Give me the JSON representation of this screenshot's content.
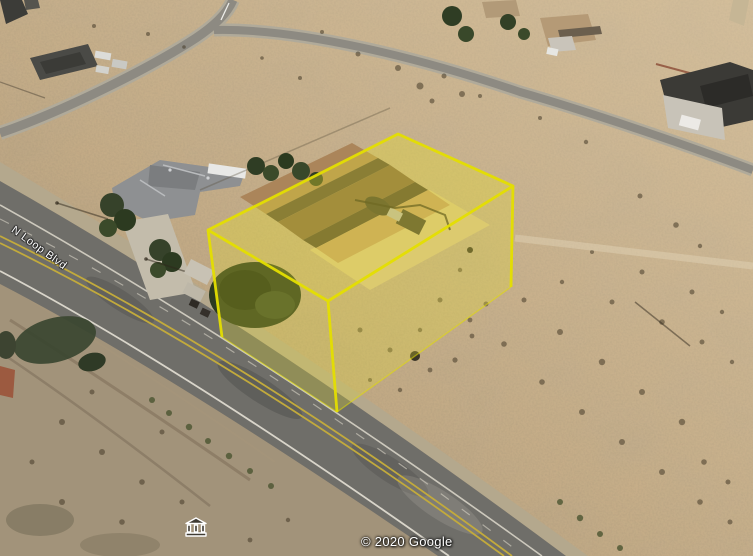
{
  "map": {
    "road_label": "N Loop Blvd",
    "attribution": "© 2020 Google",
    "poi_icon": "museum-icon",
    "highlight": {
      "name": "3d-parcel-highlight",
      "fill_color": "#e7dd2e",
      "edge_color": "#e4de00"
    },
    "terrain_colors": {
      "sand": "#c6ad87",
      "dirt": "#a2937a",
      "road": "#6f6e69"
    }
  }
}
